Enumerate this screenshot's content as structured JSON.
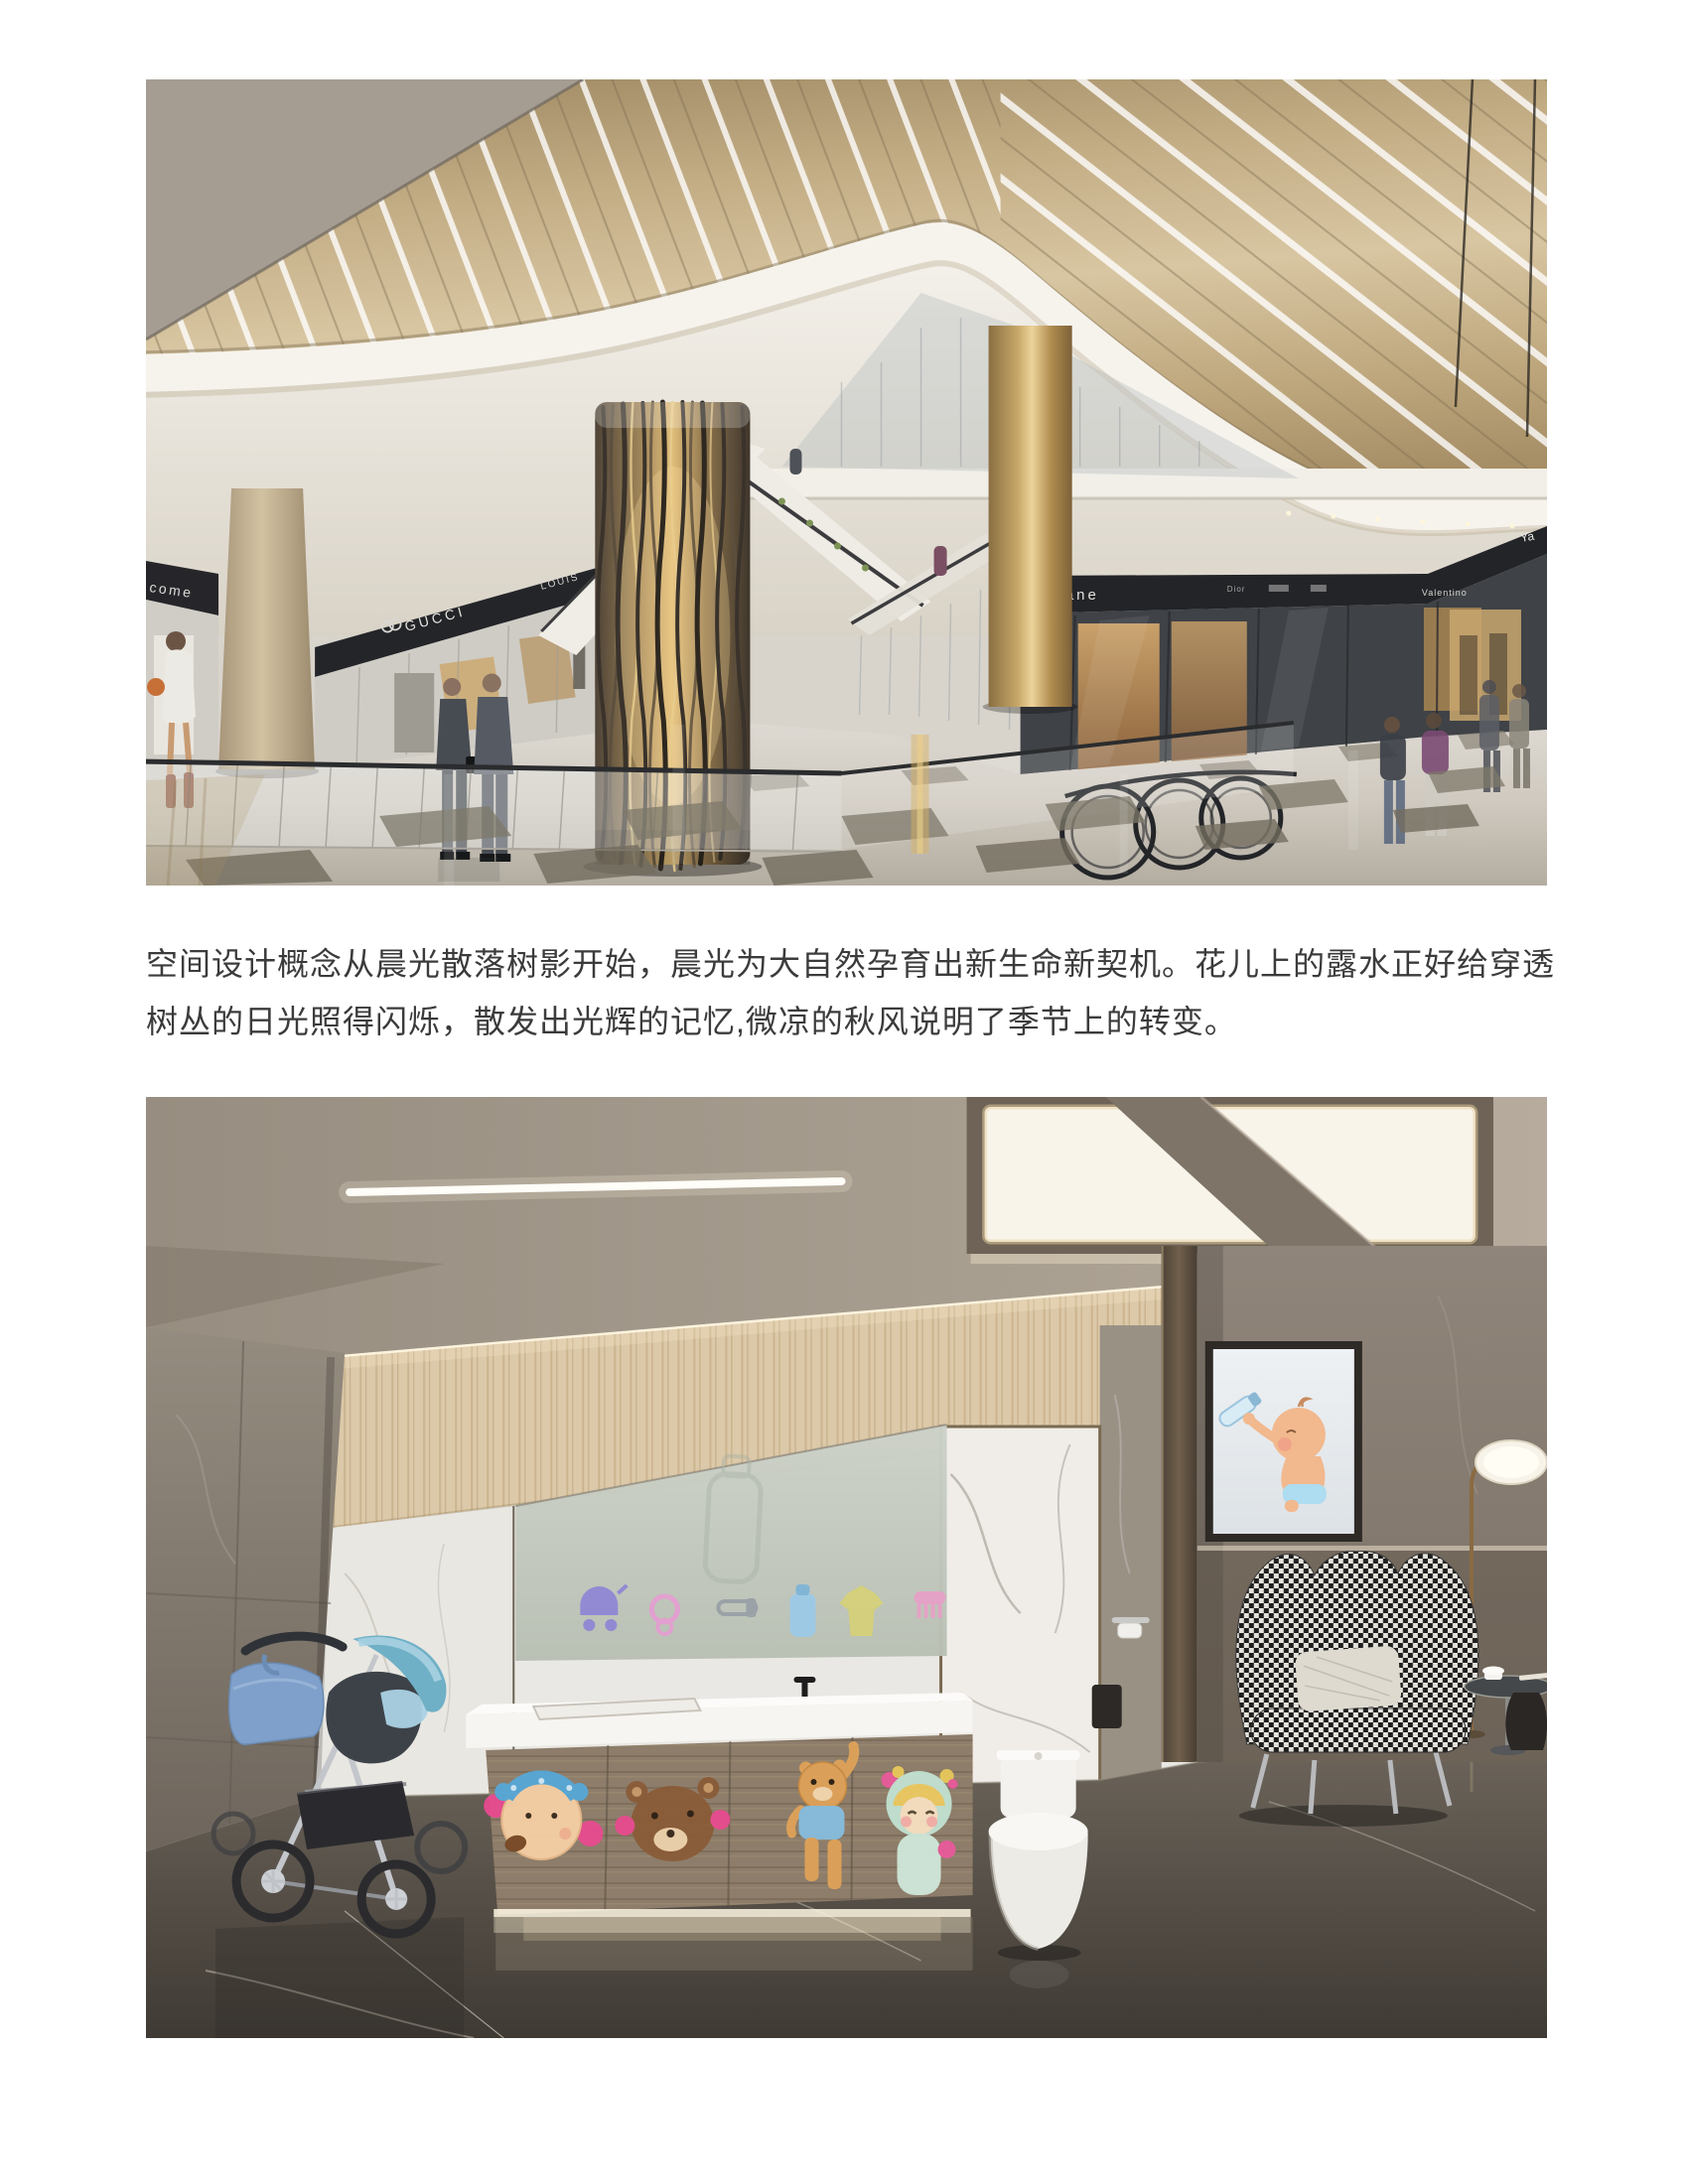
{
  "page": {
    "background_color": "#ffffff"
  },
  "body_text": {
    "line1": "空间设计概念从晨光散落树影开始，晨光为大自然孕育出新生命新契机。花儿上的露水正好给穿透",
    "line2": "树丛的日光照得闪烁，散发出光辉的记忆,微凉的秋风说明了季节上的转变。",
    "color": "#3b3b3b"
  },
  "mall_render": {
    "alt": "mall-atrium-interior-rendering",
    "signs": {
      "welcome_partial": "come",
      "gucci": "GUCCI",
      "louis_partial": "LOUIS",
      "chanel_partial": "Chane",
      "dior": "Dior",
      "valentino": "Valentino",
      "ya_partial": "Ya"
    },
    "palette": {
      "ceiling_bronze": "#c3ad85",
      "fascia_white": "#f6f3ed",
      "sign_band_dark": "#232428",
      "column_gold": "#c8a869",
      "floor_light": "#cfc9bf"
    }
  },
  "babycare_render": {
    "alt": "baby-care-room-interior-rendering",
    "glass_icons": [
      "stroller-icon",
      "pacifier-icon",
      "safety-pin-icon",
      "feeding-bottle-icon",
      "onesie-icon",
      "comb-icon"
    ],
    "cabinet_stickers": [
      "blue-bow-girl-sticker",
      "brown-bear-sticker",
      "orange-bear-sticker",
      "mint-hat-girl-sticker"
    ],
    "palette": {
      "ceiling_grey": "#a39a8c",
      "wood_band": "#d9c6a6",
      "marble_white": "#eceae6",
      "frosted_glass": "#c5cabf",
      "cabinet_wood": "#8d7d6a",
      "floor_dark": "#5f574c",
      "stroller_blue": "#6fb0c6",
      "houndstooth_dark": "#1c1c1c"
    }
  }
}
